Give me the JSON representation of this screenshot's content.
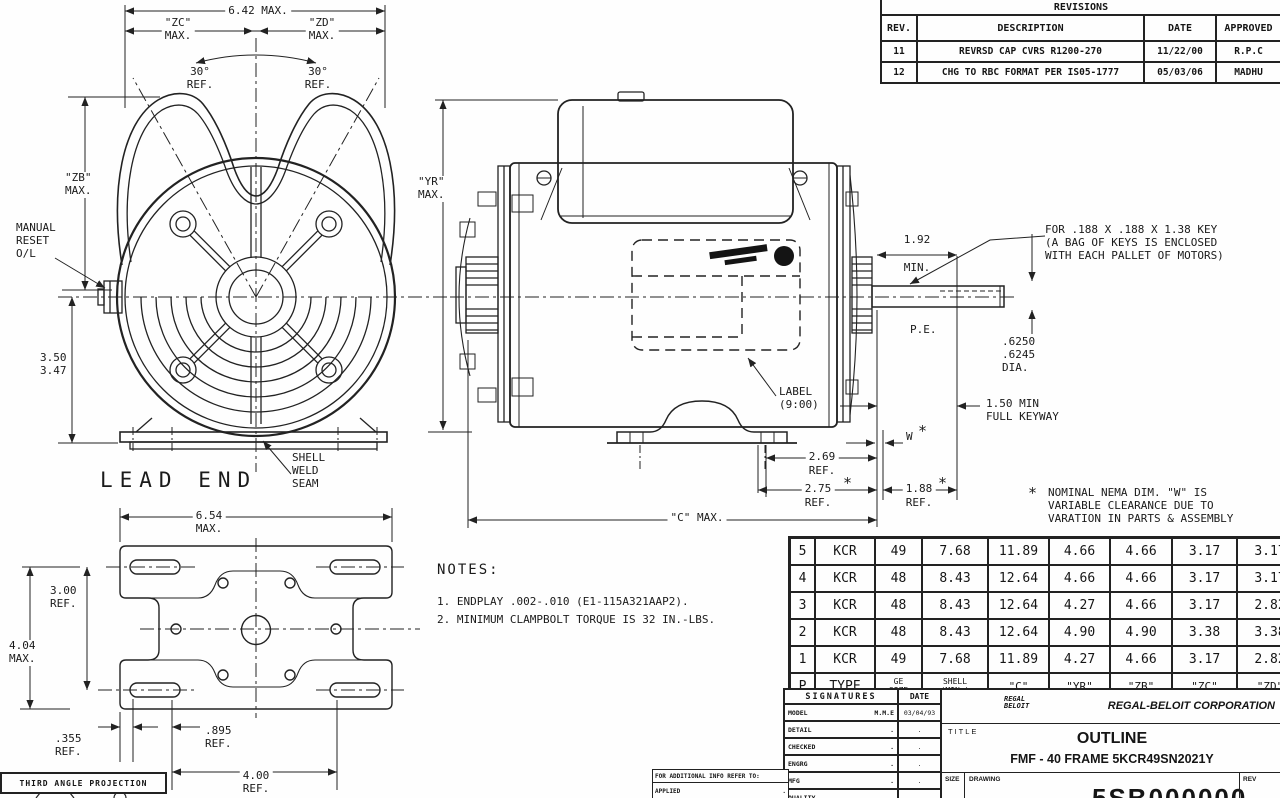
{
  "drawing": {
    "ast": "*",
    "lead_end": {
      "dim_width_top": "6.42 MAX.",
      "dim_zc": "\"ZC\"\nMAX.",
      "dim_zd": "\"ZD\"\nMAX.",
      "angle_left": "30°\nREF.",
      "angle_right": "30°\nREF.",
      "dim_zb": "\"ZB\"\nMAX.",
      "manual_reset": "MANUAL\nRESET\nO/L",
      "dim_height": "3.50\n3.47",
      "view_title": "LEAD END",
      "shell_weld_seam": "SHELL\nWELD\nSEAM"
    },
    "side": {
      "dim_yr": "\"YR\"\nMAX.",
      "dim_192": "1.92",
      "dim_192b": "MIN.",
      "key_note": "FOR .188 X .188 X 1.38 KEY\n(A BAG OF KEYS IS ENCLOSED\nWITH EACH PALLET OF MOTORS)",
      "pe": "P.E.",
      "dia": ".6250\n.6245\nDIA.",
      "keyway": "1.50 MIN\nFULL KEYWAY",
      "w_label": "W",
      "dim_269": "2.69",
      "dim_269b": "REF.",
      "dim_275": "2.75",
      "dim_275b": "REF.",
      "dim_188": "1.88",
      "dim_188b": "REF.",
      "label_900": "LABEL\n(9:00)",
      "dim_c": "\"C\" MAX.",
      "nema_note": "NOMINAL NEMA DIM. \"W\" IS\nVARIABLE CLEARANCE DUE TO\nVARATION IN PARTS & ASSEMBLY"
    },
    "footprint": {
      "dim_654": "6.54\nMAX.",
      "dim_300": "3.00\nREF.",
      "dim_404": "4.04\nMAX.",
      "dim_355": ".355\nREF.",
      "dim_895": ".895\nREF.",
      "dim_400": "4.00\nREF."
    },
    "notes": {
      "heading": "NOTES:",
      "item1": "1. ENDPLAY .002-.010 (E1-115A321AAP2).",
      "item2": "2. MINIMUM CLAMPBOLT TORQUE IS 32 IN.-LBS."
    },
    "projection": "THIRD ANGLE PROJECTION"
  },
  "revisions": {
    "title": "REVISIONS",
    "headers": [
      "REV.",
      "DESCRIPTION",
      "DATE",
      "APPROVED"
    ],
    "rows": [
      [
        "11",
        "REVRSD CAP CVRS R1200-270",
        "11/22/00",
        "R.P.C"
      ],
      [
        "12",
        "CHG TO RBC FORMAT PER IS05-1777",
        "05/03/06",
        "MADHU"
      ]
    ]
  },
  "dim_table": {
    "headers": [
      "P",
      "TYPE",
      "GE\nSIZE",
      "SHELL\n(MIN.)",
      "\"C\"",
      "\"YR\"",
      "\"ZB\"",
      "\"ZC\"",
      "\"ZD\""
    ],
    "rows": [
      [
        "5",
        "KCR",
        "49",
        "7.68",
        "11.89",
        "4.66",
        "4.66",
        "3.17",
        "3.17"
      ],
      [
        "4",
        "KCR",
        "48",
        "8.43",
        "12.64",
        "4.66",
        "4.66",
        "3.17",
        "3.17"
      ],
      [
        "3",
        "KCR",
        "48",
        "8.43",
        "12.64",
        "4.27",
        "4.66",
        "3.17",
        "2.82"
      ],
      [
        "2",
        "KCR",
        "48",
        "8.43",
        "12.64",
        "4.90",
        "4.90",
        "3.38",
        "3.38"
      ],
      [
        "1",
        "KCR",
        "49",
        "7.68",
        "11.89",
        "4.27",
        "4.66",
        "3.17",
        "2.82"
      ]
    ]
  },
  "signatures": {
    "title": "SIGNATURES",
    "date_header": "DATE",
    "rows": [
      {
        "label": "MODEL",
        "sig": "M.M.E",
        "date": "03/04/93"
      },
      {
        "label": "DETAIL",
        "sig": ".",
        "date": "."
      },
      {
        "label": "CHECKED",
        "sig": ".",
        "date": "."
      },
      {
        "label": "ENGRG",
        "sig": ".",
        "date": "."
      },
      {
        "label": "MFG",
        "sig": ".",
        "date": "."
      },
      {
        "label": "QUALITY",
        "sig": ".",
        "date": "."
      }
    ],
    "additional_info": "FOR ADDITIONAL INFO REFER TO:",
    "applied_label": "APPLIED",
    "applied_value": "."
  },
  "title_block": {
    "logo_text": "REGAL\nBELOIT",
    "company": "REGAL-BELOIT CORPORATION",
    "title_label": "TITLE",
    "title": "OUTLINE",
    "subtitle": "FMF - 40 FRAME 5KCR49SN2021Y",
    "size_label": "SIZE",
    "drawing_label": "DRAWING",
    "drawing_number": "5SB000000",
    "rev_label": "REV"
  }
}
